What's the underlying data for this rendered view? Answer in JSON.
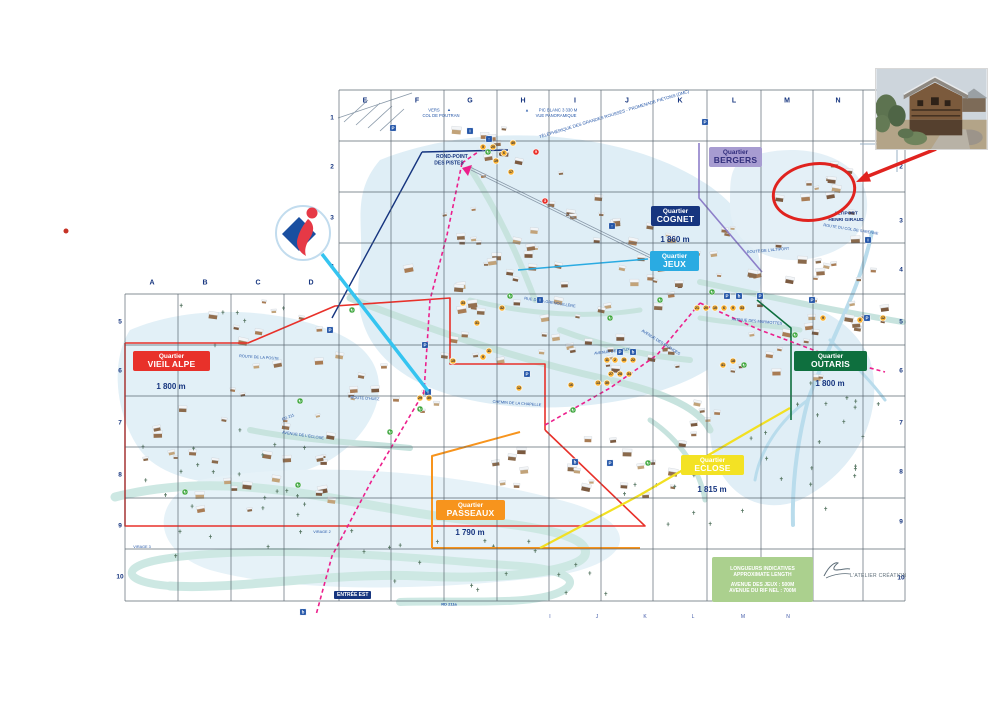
{
  "map": {
    "grid": {
      "letters_top": [
        "E",
        "F",
        "G",
        "H",
        "I",
        "J",
        "K",
        "L",
        "M",
        "N"
      ],
      "letters_left_section": [
        "A",
        "B",
        "C",
        "D"
      ],
      "letters_bottom": [
        "I",
        "J",
        "K",
        "L",
        "M",
        "N"
      ],
      "rows_inner_left": [
        "1",
        "2",
        "3",
        "4"
      ],
      "rows_outer_left": [
        "5",
        "6",
        "7",
        "8",
        "9",
        "10"
      ],
      "rows_right": [
        "2",
        "3",
        "4",
        "5",
        "6",
        "7",
        "8",
        "9",
        "10"
      ]
    },
    "quartiers": [
      {
        "id": "bergers",
        "label": "Quartier",
        "name": "BERGERS",
        "altitude": "",
        "bg": "#a79cd1",
        "fg": "#312e7c"
      },
      {
        "id": "cognet",
        "label": "Quartier",
        "name": "COGNET",
        "altitude": "1 860 m",
        "bg": "#16357f",
        "fg": "#ffffff"
      },
      {
        "id": "jeux",
        "label": "Quartier",
        "name": "JEUX",
        "altitude": "",
        "bg": "#2aabe2",
        "fg": "#ffffff"
      },
      {
        "id": "vieil-alpe",
        "label": "Quartier",
        "name": "VIEIL ALPE",
        "altitude": "1 800 m",
        "bg": "#e8312a",
        "fg": "#ffffff"
      },
      {
        "id": "outaris",
        "label": "Quartier",
        "name": "OUTARIS",
        "altitude": "1 800 m",
        "bg": "#0e6f3e",
        "fg": "#ffffff"
      },
      {
        "id": "eclose",
        "label": "Quartier",
        "name": "ECLOSE",
        "altitude": "1 815 m",
        "bg": "#f3e224",
        "fg": "#ffffff"
      },
      {
        "id": "passeaux",
        "label": "Quartier",
        "name": "PASSEAUX",
        "altitude": "1 790 m",
        "bg": "#f7941d",
        "fg": "#ffffff"
      }
    ],
    "place_labels": [
      {
        "t": "▲",
        "x": 449,
        "y": 109.5,
        "s": 4
      },
      {
        "t": "VERS",
        "x": 434,
        "y": 110,
        "s": 4.2
      },
      {
        "t": "COL DE POUTRAN",
        "x": 441,
        "y": 115.5,
        "s": 4.2
      },
      {
        "t": "▲",
        "x": 527,
        "y": 110,
        "s": 4
      },
      {
        "t": "PIC BLANC 3 330 M",
        "x": 558,
        "y": 110,
        "s": 4.2
      },
      {
        "t": "VUE PANORAMIQUE",
        "x": 556,
        "y": 115.5,
        "s": 4.2
      },
      {
        "t": "TÉLÉPHÉRIQUE DES GRANDES ROUSSES - PROMENADE PIÉTONS (DMC)",
        "x": 614,
        "y": 114,
        "r": -17,
        "s": 4.4
      },
      {
        "t": "ROND-POINT",
        "x": 452,
        "y": 157,
        "s": 5,
        "b": 1,
        "c": "#16357f"
      },
      {
        "t": "DES PISTES",
        "x": 449,
        "y": 163.5,
        "s": 5,
        "b": 1,
        "c": "#16357f"
      },
      {
        "t": "ALTIPORT",
        "x": 846,
        "y": 214,
        "s": 4.8,
        "b": 1,
        "c": "#16357f"
      },
      {
        "t": "HENRI GIRAUD",
        "x": 846,
        "y": 220.5,
        "s": 4.8,
        "b": 1,
        "c": "#16357f"
      },
      {
        "t": "ROUTE DU COL DE SARENNE",
        "x": 851,
        "y": 229,
        "r": 9,
        "s": 3.9
      },
      {
        "t": "ROUTE DE L'ALTIPORT",
        "x": 768,
        "y": 250,
        "r": -5,
        "s": 3.9
      },
      {
        "t": "AVENUE DES MARMOTTES",
        "x": 757,
        "y": 321,
        "r": 5,
        "s": 3.9
      },
      {
        "t": "RUE DE LA GRENOUILLÈRE",
        "x": 550,
        "y": 302,
        "r": 9,
        "s": 3.9
      },
      {
        "t": "AVENUE DES BRANDES",
        "x": 661,
        "y": 342,
        "r": 32,
        "s": 3.9
      },
      {
        "t": "AVENUE DES JEUX",
        "x": 612,
        "y": 351,
        "r": -7,
        "s": 3.9
      },
      {
        "t": "AVENUE DE L'ÉCLOSE",
        "x": 303,
        "y": 435,
        "r": 8,
        "s": 3.9
      },
      {
        "t": "ROUTE D'HUEZ",
        "x": 365,
        "y": 398,
        "r": 3,
        "s": 3.9
      },
      {
        "t": "ROUTE DE LA POSTE",
        "x": 259,
        "y": 357,
        "r": 4,
        "s": 3.9
      },
      {
        "t": "RD 211",
        "x": 288,
        "y": 417,
        "r": -22,
        "s": 3.9
      },
      {
        "t": "RD 211a",
        "x": 449,
        "y": 604,
        "s": 4,
        "b": 1
      },
      {
        "t": "CHEMIN DE LA CHAPELLE",
        "x": 517,
        "y": 403,
        "r": 4,
        "s": 3.9
      },
      {
        "t": "VIRAGE 2",
        "x": 322,
        "y": 532,
        "s": 3.8
      },
      {
        "t": "VIRAGE 3",
        "x": 142,
        "y": 547,
        "s": 3.8
      }
    ],
    "poi_markers": [
      {
        "n": "5",
        "x": 483,
        "y": 147
      },
      {
        "n": "20",
        "x": 493,
        "y": 147
      },
      {
        "n": "40",
        "x": 513,
        "y": 143
      },
      {
        "n": "6",
        "x": 504,
        "y": 153
      },
      {
        "n": "19",
        "x": 496,
        "y": 161
      },
      {
        "n": "17",
        "x": 511,
        "y": 172
      },
      {
        "n": "9",
        "x": 536,
        "y": 152,
        "c": "#e8312a"
      },
      {
        "n": "3",
        "x": 545,
        "y": 201,
        "c": "#e8312a"
      },
      {
        "n": "33",
        "x": 463,
        "y": 303
      },
      {
        "n": "32",
        "x": 502,
        "y": 308
      },
      {
        "n": "31",
        "x": 477,
        "y": 323
      },
      {
        "n": "11",
        "x": 489,
        "y": 351
      },
      {
        "n": "9",
        "x": 483,
        "y": 357
      },
      {
        "n": "15",
        "x": 453,
        "y": 361
      },
      {
        "n": "12",
        "x": 519,
        "y": 388
      },
      {
        "n": "16",
        "x": 571,
        "y": 385
      },
      {
        "n": "11",
        "x": 607,
        "y": 360
      },
      {
        "n": "2",
        "x": 615,
        "y": 360
      },
      {
        "n": "30",
        "x": 624,
        "y": 360
      },
      {
        "n": "22",
        "x": 633,
        "y": 360
      },
      {
        "n": "27",
        "x": 611,
        "y": 374
      },
      {
        "n": "28",
        "x": 620,
        "y": 374
      },
      {
        "n": "34",
        "x": 629,
        "y": 374
      },
      {
        "n": "13",
        "x": 598,
        "y": 383
      },
      {
        "n": "30",
        "x": 607,
        "y": 383
      },
      {
        "n": "21",
        "x": 697,
        "y": 308
      },
      {
        "n": "20",
        "x": 706,
        "y": 308
      },
      {
        "n": "10",
        "x": 715,
        "y": 308
      },
      {
        "n": "6",
        "x": 724,
        "y": 308
      },
      {
        "n": "9",
        "x": 733,
        "y": 308
      },
      {
        "n": "33",
        "x": 742,
        "y": 308
      },
      {
        "n": "9",
        "x": 823,
        "y": 318
      },
      {
        "n": "8",
        "x": 860,
        "y": 320
      },
      {
        "n": "12",
        "x": 883,
        "y": 318
      },
      {
        "n": "41",
        "x": 723,
        "y": 365
      },
      {
        "n": "18",
        "x": 733,
        "y": 361
      },
      {
        "n": "29",
        "x": 420,
        "y": 398
      },
      {
        "n": "30",
        "x": 429,
        "y": 398
      }
    ],
    "poi_icons": [
      {
        "t": "parking",
        "x": 393,
        "y": 128
      },
      {
        "t": "parking",
        "x": 705,
        "y": 122
      },
      {
        "t": "parking",
        "x": 727,
        "y": 296
      },
      {
        "t": "parking",
        "x": 760,
        "y": 296
      },
      {
        "t": "parking",
        "x": 620,
        "y": 352
      },
      {
        "t": "parking",
        "x": 812,
        "y": 300
      },
      {
        "t": "parking",
        "x": 330,
        "y": 330
      },
      {
        "t": "parking",
        "x": 425,
        "y": 345
      },
      {
        "t": "parking",
        "x": 527,
        "y": 374
      },
      {
        "t": "parking",
        "x": 610,
        "y": 463
      },
      {
        "t": "parking",
        "x": 867,
        "y": 318
      },
      {
        "t": "info",
        "x": 470,
        "y": 131
      },
      {
        "t": "info",
        "x": 868,
        "y": 240
      },
      {
        "t": "info",
        "x": 428,
        "y": 392
      },
      {
        "t": "info",
        "x": 540,
        "y": 300
      },
      {
        "t": "bus",
        "x": 739,
        "y": 296
      },
      {
        "t": "bus",
        "x": 633,
        "y": 352
      },
      {
        "t": "bus",
        "x": 575,
        "y": 462
      },
      {
        "t": "bus",
        "x": 303,
        "y": 612
      },
      {
        "t": "lift",
        "x": 612,
        "y": 226
      },
      {
        "t": "lift",
        "x": 489,
        "y": 139
      },
      {
        "t": "recycling",
        "x": 488,
        "y": 152
      },
      {
        "t": "recycling",
        "x": 680,
        "y": 268
      },
      {
        "t": "recycling",
        "x": 712,
        "y": 292
      },
      {
        "t": "recycling",
        "x": 795,
        "y": 335
      },
      {
        "t": "recycling",
        "x": 420,
        "y": 409
      },
      {
        "t": "recycling",
        "x": 300,
        "y": 401
      },
      {
        "t": "recycling",
        "x": 390,
        "y": 432
      },
      {
        "t": "recycling",
        "x": 573,
        "y": 410
      },
      {
        "t": "recycling",
        "x": 648,
        "y": 463
      },
      {
        "t": "recycling",
        "x": 185,
        "y": 492
      },
      {
        "t": "recycling",
        "x": 510,
        "y": 296
      },
      {
        "t": "recycling",
        "x": 610,
        "y": 318
      },
      {
        "t": "recycling",
        "x": 660,
        "y": 300
      },
      {
        "t": "recycling",
        "x": 744,
        "y": 365
      },
      {
        "t": "recycling",
        "x": 352,
        "y": 310
      },
      {
        "t": "recycling",
        "x": 452,
        "y": 361
      },
      {
        "t": "recycling",
        "x": 298,
        "y": 485
      }
    ],
    "icon_glyphs": {
      "parking": "P",
      "info": "i",
      "bus": "b",
      "lift": "↑",
      "recycling": "↻"
    },
    "legend": {
      "bg": "#abd08e",
      "lines": [
        "LONGUEURS INDICATIVES",
        "APPROXIMATE LENGTH",
        "AVENUE DES JEUX : 500M",
        "AVENUE DU RIF NEL : 700M"
      ]
    },
    "credit": "L'ATELIER CRÉATION",
    "entree_est": "ENTRÉE EST"
  },
  "annotations": {
    "red_circle_color": "#e0231f",
    "red_arrow_color": "#e0231f",
    "callout_color": "#35c4f0",
    "red_dot_color": "#c63226",
    "logo": {
      "diamond": "#1a4fa0",
      "figure": "#e63946"
    },
    "photo_subject": "mountain chalet photo"
  }
}
